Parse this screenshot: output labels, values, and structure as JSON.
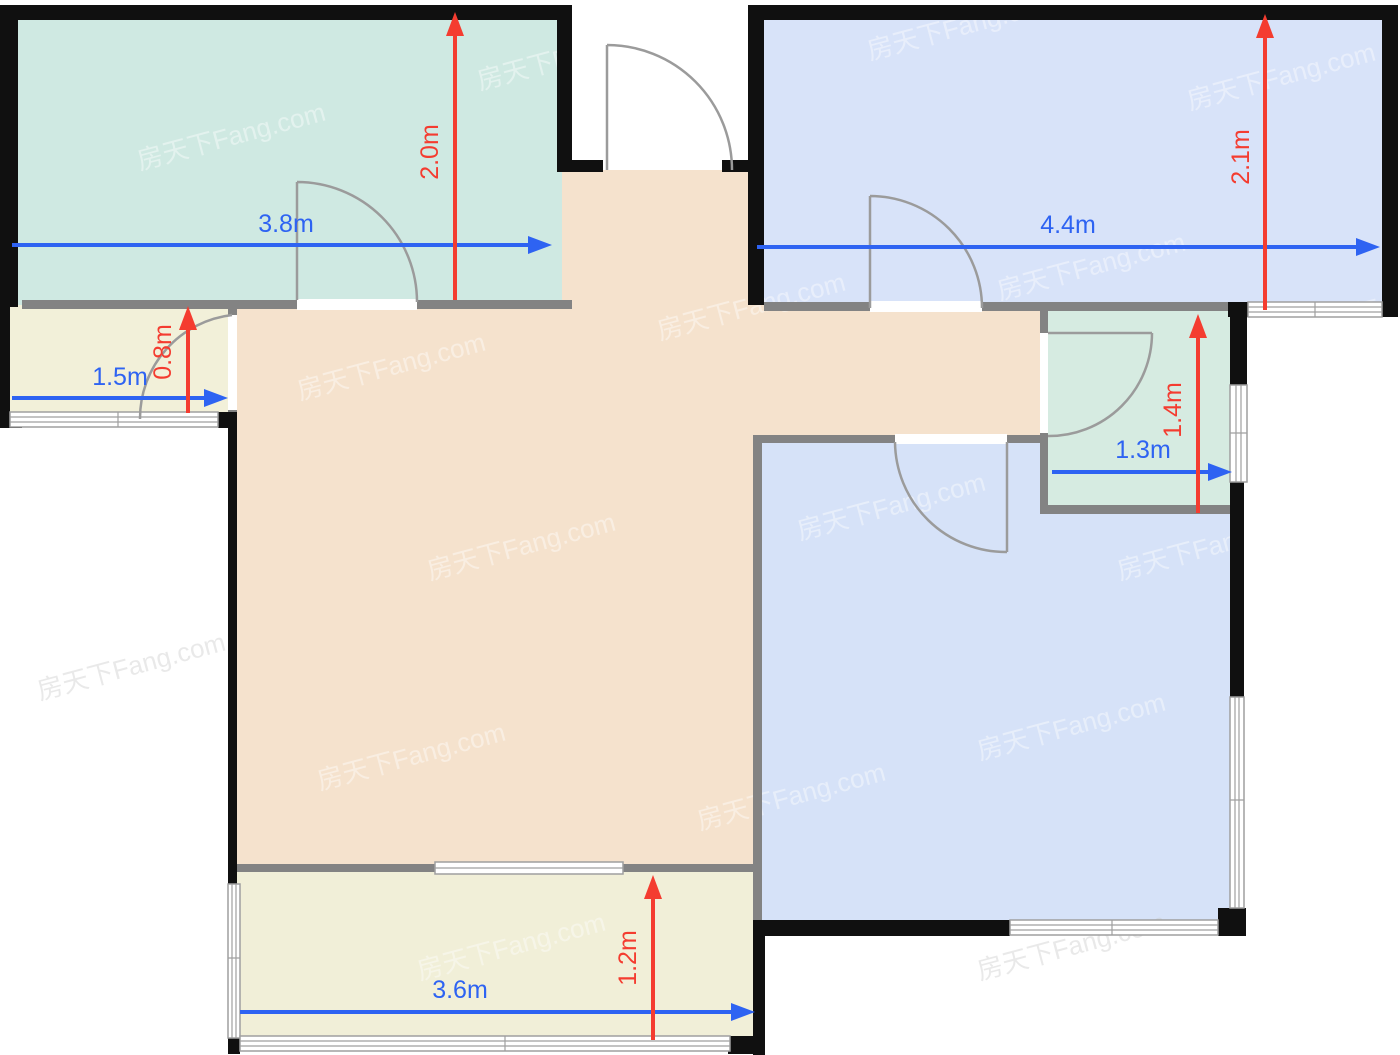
{
  "colors": {
    "accent-blue": "#2E63F2",
    "accent-red": "#F43C30",
    "wall-black": "#101010",
    "wall-gray": "#838383",
    "door-gray": "#9B9B9B",
    "room-teal": "#CFE9E2",
    "room-mint": "#D6EBE1",
    "room-blue-top": "#D8E3F9",
    "room-blue-bottom": "#D6E2F8",
    "room-tan": "#F5E2CD",
    "room-beige": "#F2F0D9",
    "room-balcony": "#F1EFD8"
  },
  "watermark": {
    "text": "房天下Fang.com"
  },
  "dimensions": [
    {
      "id": "bedroom-left-width",
      "label": "3.8m",
      "orientation": "horizontal",
      "color": "blue"
    },
    {
      "id": "bedroom-left-depth",
      "label": "2.0m",
      "orientation": "vertical",
      "color": "red"
    },
    {
      "id": "bedroom-right-width",
      "label": "4.4m",
      "orientation": "horizontal",
      "color": "blue"
    },
    {
      "id": "bedroom-right-depth",
      "label": "2.1m",
      "orientation": "vertical",
      "color": "red"
    },
    {
      "id": "storage-width",
      "label": "1.5m",
      "orientation": "horizontal",
      "color": "blue"
    },
    {
      "id": "storage-depth",
      "label": "0.8m",
      "orientation": "vertical",
      "color": "red"
    },
    {
      "id": "bathroom-width",
      "label": "1.3m",
      "orientation": "horizontal",
      "color": "blue"
    },
    {
      "id": "bathroom-depth",
      "label": "1.4m",
      "orientation": "vertical",
      "color": "red"
    },
    {
      "id": "balcony-width",
      "label": "3.6m",
      "orientation": "horizontal",
      "color": "blue"
    },
    {
      "id": "balcony-depth",
      "label": "1.2m",
      "orientation": "vertical",
      "color": "red"
    }
  ]
}
